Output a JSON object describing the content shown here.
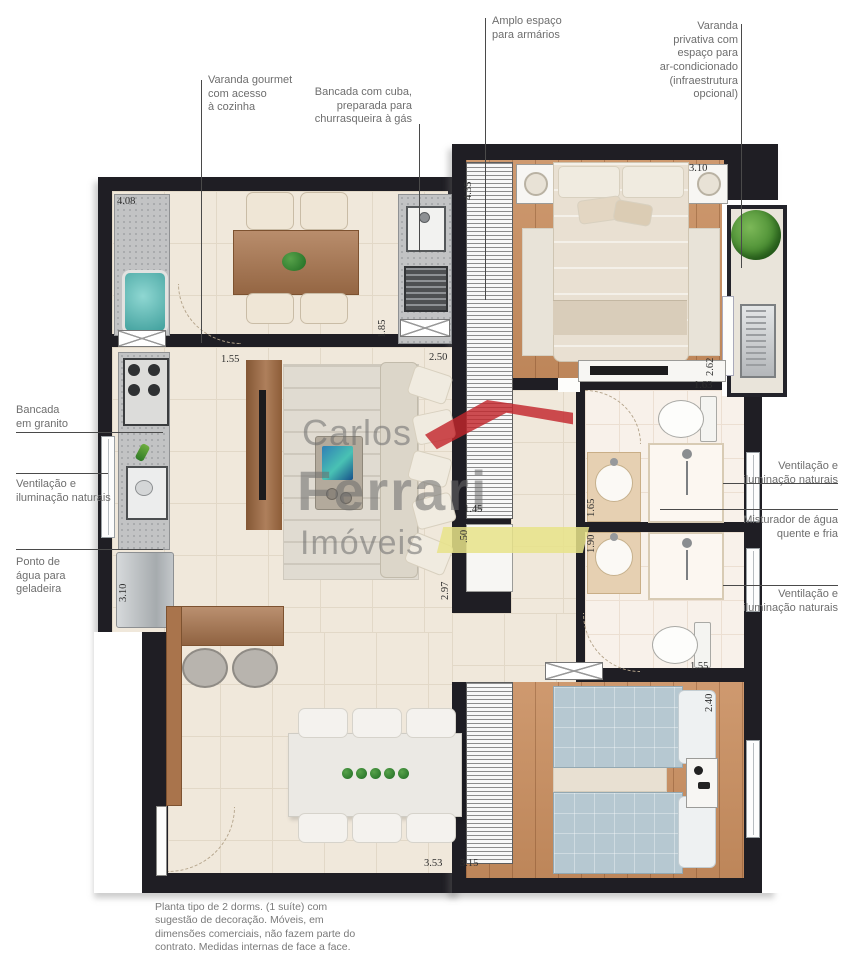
{
  "callouts": {
    "varanda_gourmet": "Varanda gourmet\ncom acesso\nà cozinha",
    "bancada_cuba": "Bancada com cuba,\npreparada para\nchurrasqueira à gás",
    "amplo_espaco": "Amplo espaço\npara armários",
    "varanda_privativa": "Varanda\nprivativa com\nespaço para\nar-condicionado\n(infraestrutura\nopcional)",
    "bancada_granito": "Bancada\nem granito",
    "ventilacao_esq": "Ventilação e\niluminação naturais",
    "ponto_agua": "Ponto de\nágua para\ngeladeira",
    "ventilacao_dir_1": "Ventilação e\niluminação naturais",
    "misturador": "Misturador de água\nquente e fria",
    "ventilacao_dir_2": "Ventilação e\niluminação naturais"
  },
  "dims": {
    "varanda_largura": "4.08",
    "varanda_prof": "1.85",
    "passagem": "1.55",
    "sala_largura": "2.50",
    "suite_prof": "4.35",
    "suite_largura": "3.10",
    "varanda_priv_prof": "2.62",
    "banho1_largura": "1.63",
    "banho1_bancada": "1.65",
    "banho2_bancada": "1.90",
    "circulacao": "1.45",
    "circulacao_meio": ".50",
    "sala_comp": "2.97",
    "cozinha_prof": "3.10",
    "banho2_largura": "1.55",
    "dorm2_prof": "2.40",
    "sala_jantar": "3.53",
    "dorm2_largura": "3.15"
  },
  "watermark": {
    "line1": "Carlos",
    "line2": "Ferrari",
    "line3": "Imóveis"
  },
  "disclaimer": "Planta tipo de 2 dorms. (1 suíte) com\nsugestão de decoração. Móveis, em\ndimensões comerciais, não fazem parte do\ncontrato. Medidas internas de face a face.",
  "colors": {
    "wall": "#1f1e24",
    "tile_floor": "#f0e8db",
    "wood_floor": "#c98e5f",
    "bath_floor": "#f8f1ea",
    "granite": "#c2c3c4",
    "brand_red": "#c2262c",
    "brand_yellow": "#e7e388",
    "watermark_gray": "#6c6c6c",
    "bed_blue": "#b6c8d1"
  }
}
